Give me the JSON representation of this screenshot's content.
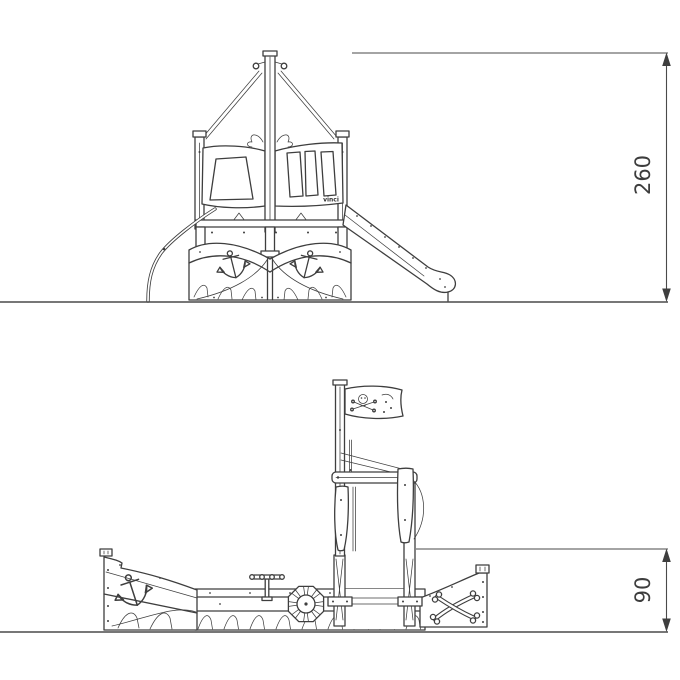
{
  "drawing": {
    "background": "#ffffff",
    "stroke_color": "#3e3e3e",
    "dimension_color": "#4a4a4a",
    "logo_text": "vinci",
    "views": [
      {
        "id": "front-elevation",
        "dimensions": [
          {
            "label": "260",
            "orientation": "vertical"
          }
        ]
      },
      {
        "id": "side-elevation",
        "dimensions": [
          {
            "label": "90",
            "orientation": "vertical"
          }
        ]
      }
    ]
  }
}
